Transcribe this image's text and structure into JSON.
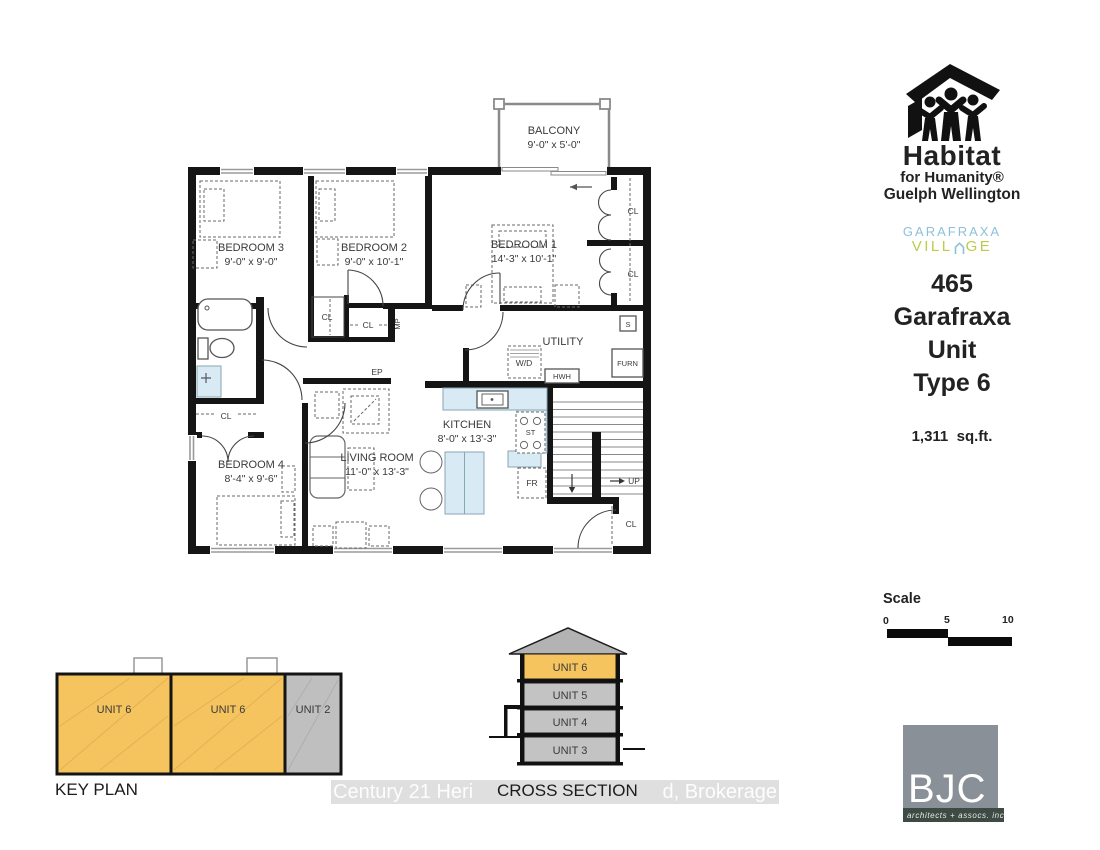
{
  "branding": {
    "habitat_name": "Habitat",
    "habitat_sub": "for Humanity®",
    "habitat_region": "Guelph Wellington",
    "village_top": "GARAFRAXA",
    "village_pre": "VILL",
    "village_post": "GE",
    "colors": {
      "village_blue": "#8cc2d9",
      "village_green": "#bccc49"
    }
  },
  "title_block": {
    "line1": "465",
    "line2": "Garafraxa",
    "line3": "Unit",
    "line4": "Type 6",
    "area": "1,311  sq.ft."
  },
  "scale_bar": {
    "label": "Scale",
    "tick0": "0",
    "tick5": "5",
    "tick10": "10"
  },
  "floor_plan": {
    "balcony": {
      "name": "BALCONY",
      "dims": "9'-0\" x 5'-0\""
    },
    "bedroom1": {
      "name": "BEDROOM 1",
      "dims": "14'-3\" x 10'-1\""
    },
    "bedroom2": {
      "name": "BEDROOM 2",
      "dims": "9'-0\" x 10'-1\""
    },
    "bedroom3": {
      "name": "BEDROOM 3",
      "dims": "9'-0\" x 9'-0\""
    },
    "bedroom4": {
      "name": "BEDROOM 4",
      "dims": "8'-4\" x 9'-6\""
    },
    "living": {
      "name": "LIVING ROOM",
      "dims": "11'-0\" x 13'-3\""
    },
    "kitchen": {
      "name": "KITCHEN",
      "dims": "8'-0\" x 13'-3\""
    },
    "utility": "UTILITY",
    "labels": {
      "cl": "CL",
      "wd": "W/D",
      "hwh": "HWH",
      "furn": "FURN",
      "s": "S",
      "up": "UP",
      "ep": "EP",
      "mp": "MP",
      "fr": "FR",
      "st": "ST"
    }
  },
  "key_plan": {
    "title": "KEY PLAN",
    "units": [
      "UNIT 6",
      "UNIT 6",
      "UNIT 2"
    ],
    "colors": {
      "highlight": "#f5c45e",
      "other": "#bfbfbf"
    }
  },
  "cross_section": {
    "title": "CROSS SECTION",
    "units": [
      "UNIT 6",
      "UNIT 5",
      "UNIT 4",
      "UNIT 3"
    ]
  },
  "watermark": {
    "left": "Century 21 Heri",
    "right": "d, Brokerage"
  },
  "bjc": {
    "initials": "BJC",
    "tagline": "architects + assocs.  inc."
  }
}
